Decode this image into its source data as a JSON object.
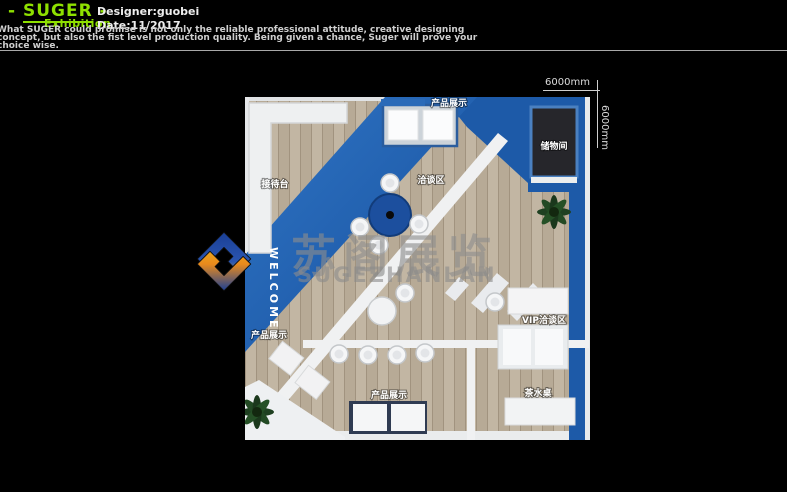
{
  "header": {
    "brand": {
      "prefix": "-",
      "name": "SUGER",
      "suffix": "-",
      "sub": "Exhibition"
    },
    "designer": "Designer:guobei",
    "date": "Date:11/2017",
    "tagline": [
      "What SUGER could promise is not only the reliable professional attitude, creative designing",
      "concept, but also the fist level production quality. Being given a chance, Suger will prove your",
      "choice wise."
    ]
  },
  "dimensions": {
    "top": "6000mm",
    "right": "6000mm"
  },
  "plan": {
    "labels": {
      "reception": "接待台",
      "display_top": "产品展示",
      "meeting": "洽谈区",
      "storage": "储物间",
      "vip": "VIP洽谈区",
      "display_left": "产品展示",
      "display_bottom": "产品展示",
      "tea": "茶水桌",
      "welcome": "WELCOME"
    }
  },
  "watermark": {
    "cn": "苏阁展览",
    "en": "SUGEZHANLAN"
  },
  "colors": {
    "accent_green": "#8ee000",
    "booth_blue": "#1d5aa8",
    "wood": "#c2b6a3",
    "storage_dark": "#26262b"
  }
}
